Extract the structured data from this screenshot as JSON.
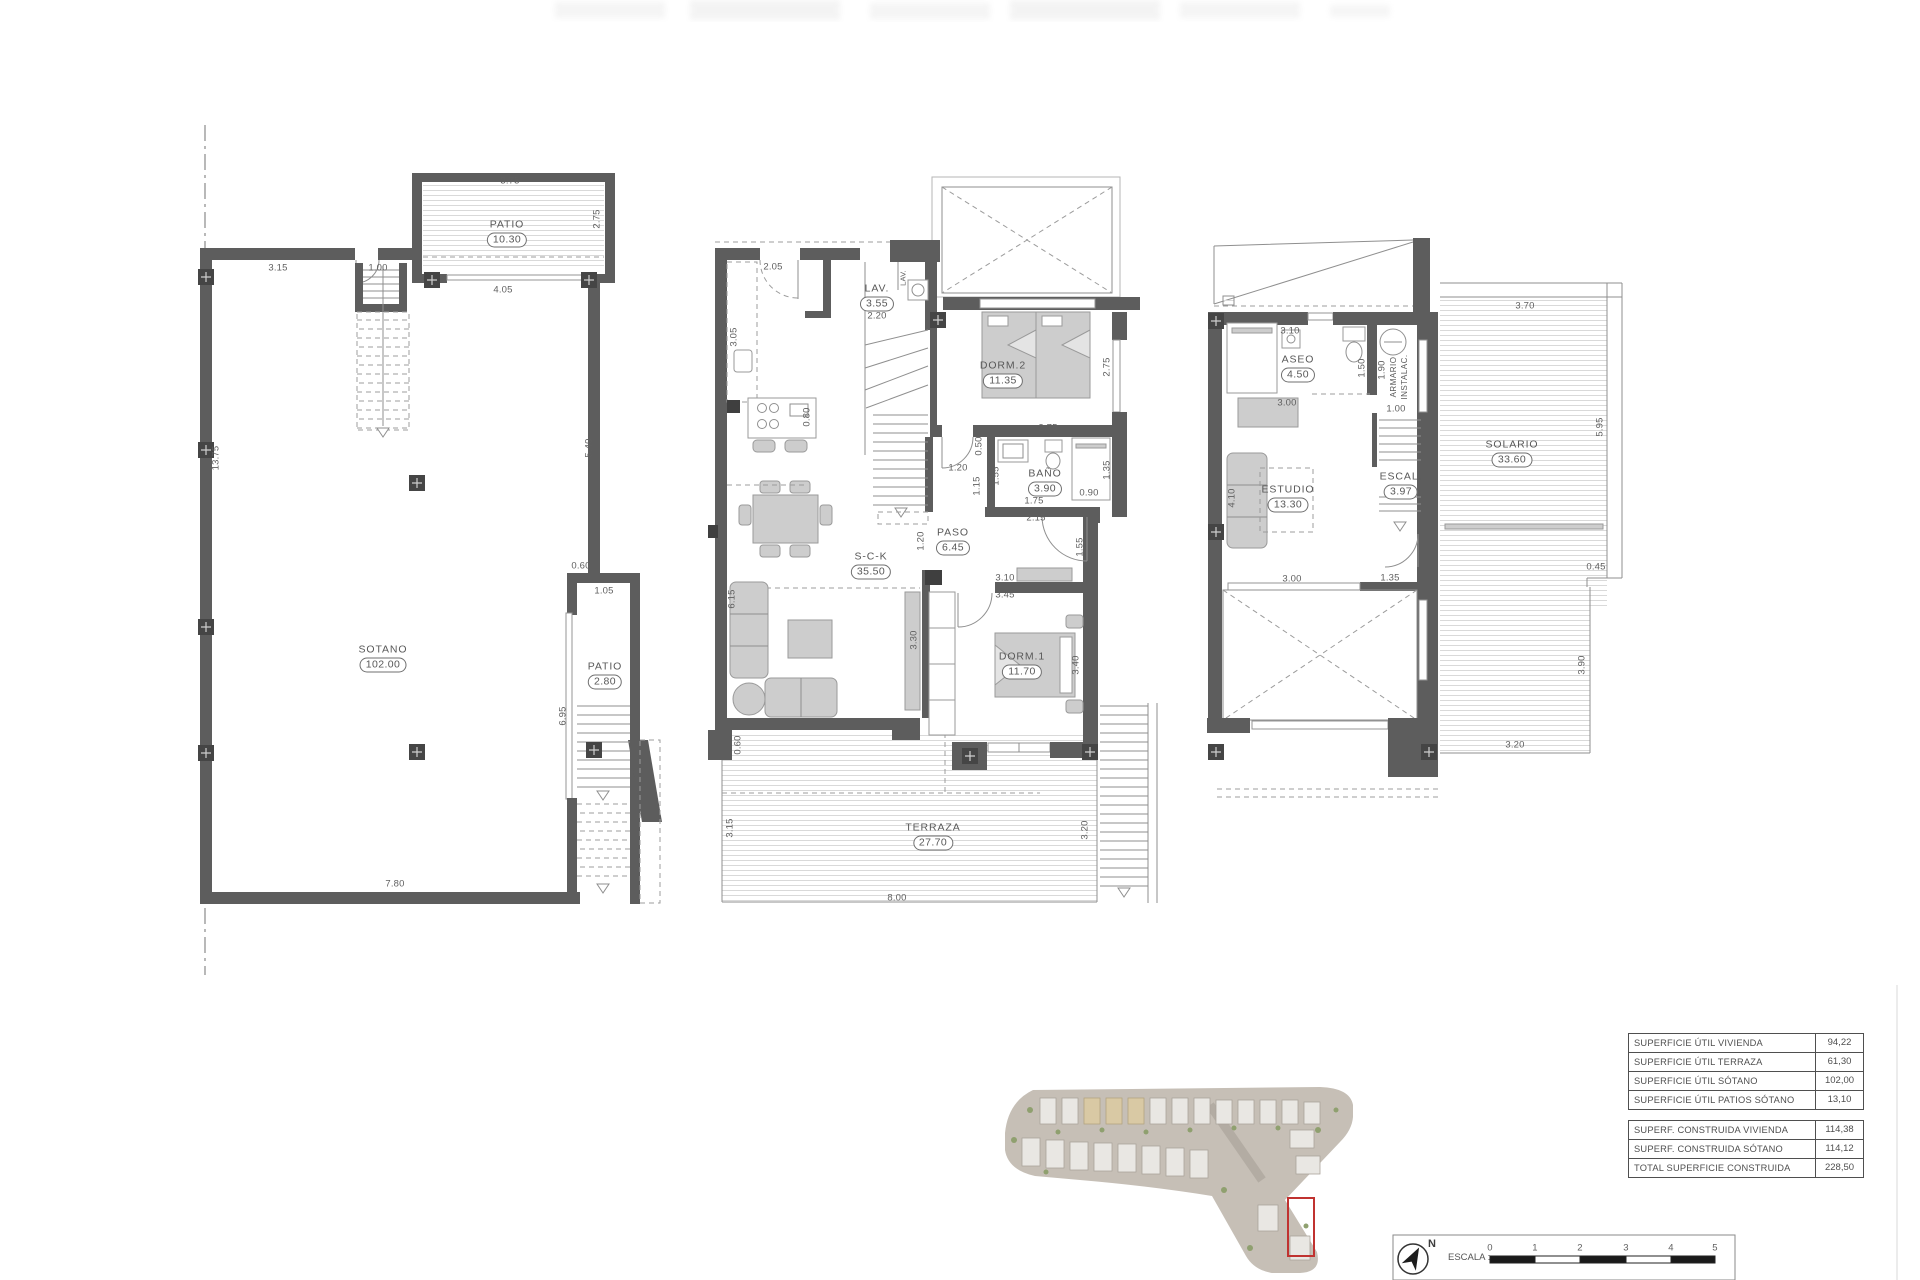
{
  "plans": {
    "sotano": {
      "rooms": {
        "patio_top": {
          "name": "PATIO",
          "area": "10.30"
        },
        "sotano": {
          "name": "SOTANO",
          "area": "102.00"
        },
        "patio_side": {
          "name": "PATIO",
          "area": "2.80"
        }
      },
      "dims": [
        "3.75",
        "3.15",
        "1.00",
        "2.75",
        "4.05",
        "5.40",
        "13.75",
        "0.60",
        "1.05",
        "6.95",
        "7.80"
      ]
    },
    "planta_baja": {
      "rooms": {
        "lav": {
          "name": "LAV.",
          "area": "3.55"
        },
        "lav2": {
          "name": "LAV."
        },
        "dorm2": {
          "name": "DORM.2",
          "area": "11.35"
        },
        "bano": {
          "name": "BAÑO",
          "area": "3.90"
        },
        "paso": {
          "name": "PASO",
          "area": "6.45"
        },
        "sck": {
          "name": "S-C-K",
          "area": "35.50"
        },
        "dorm1": {
          "name": "DORM.1",
          "area": "11.70"
        },
        "terraza": {
          "name": "TERRAZA",
          "area": "27.70"
        }
      },
      "dims": [
        "2.05",
        "3.05",
        "2.20",
        "0.80",
        "2.75",
        "2.75",
        "0.50",
        "1.20",
        "1.15",
        "1.55",
        "1.35",
        "0.90",
        "1.75",
        "2.15",
        "1.20",
        "1.55",
        "3.10",
        "3.45",
        "3.40",
        "3.30",
        "6.15",
        "0.60",
        "3.15",
        "8.00",
        "3.20"
      ]
    },
    "planta_alta": {
      "rooms": {
        "aseo": {
          "name": "ASEO",
          "area": "4.50"
        },
        "armario": {
          "line1": "ARMARIO",
          "line2": "INSTALAC."
        },
        "estudio": {
          "name": "ESTUDIO",
          "area": "13.30"
        },
        "escal": {
          "name": "ESCAL.",
          "area": "3.97"
        },
        "solario": {
          "name": "SOLARIO",
          "area": "33.60"
        }
      },
      "dims": [
        "3.10",
        "1.50",
        "1.90",
        "1.00",
        "3.00",
        "4.10",
        "3.00",
        "1.35",
        "3.70",
        "5.95",
        "0.45",
        "3.90",
        "3.20"
      ]
    }
  },
  "tables": {
    "util": [
      {
        "label": "SUPERFICIE ÚTIL VIVIENDA",
        "value": "94,22"
      },
      {
        "label": "SUPERFICIE ÚTIL TERRAZA",
        "value": "61,30"
      },
      {
        "label": "SUPERFICIE ÚTIL SÓTANO",
        "value": "102,00"
      },
      {
        "label": "SUPERFICIE ÚTIL PATIOS SÓTANO",
        "value": "13,10"
      }
    ],
    "construida": [
      {
        "label": "SUPERF. CONSTRUIDA VIVIENDA",
        "value": "114,38"
      },
      {
        "label": "SUPERF. CONSTRUIDA SÓTANO",
        "value": "114,12"
      },
      {
        "label": "TOTAL SUPERFICIE CONSTRUIDA",
        "value": "228,50"
      }
    ]
  },
  "scalebar": {
    "label": "ESCALA :",
    "ticks": [
      "0",
      "1",
      "2",
      "3",
      "4",
      "5"
    ]
  },
  "compass": {
    "label": "N"
  }
}
